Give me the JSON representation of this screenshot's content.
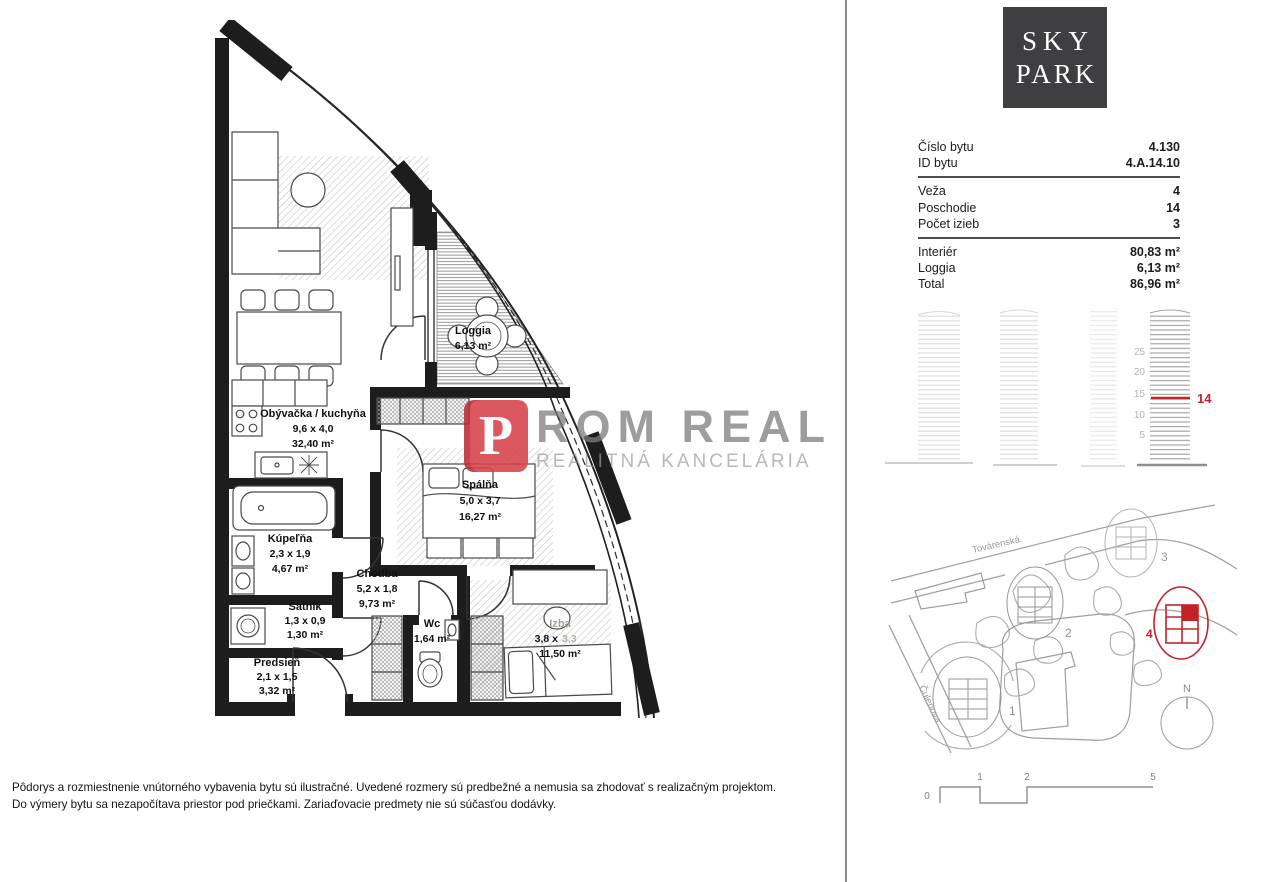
{
  "logo": {
    "line1": "SKY",
    "line2": "PARK"
  },
  "watermark": {
    "prefix": "P",
    "name": "ROM REAL",
    "subtitle": "REALITNÁ KANCELÁRIA"
  },
  "info": {
    "rows": [
      {
        "label": "Číslo bytu",
        "value": "4.130"
      },
      {
        "label": "ID bytu",
        "value": "4.A.14.10"
      },
      {
        "label": "Veža",
        "value": "4"
      },
      {
        "label": "Poschodie",
        "value": "14"
      },
      {
        "label": "Počet izieb",
        "value": "3"
      },
      {
        "label": "Interiér",
        "value": "80,83 m²"
      },
      {
        "label": "Loggia",
        "value": "6,13 m²"
      },
      {
        "label": "Total",
        "value": "86,96 m²"
      }
    ]
  },
  "floorplan": {
    "rooms": [
      {
        "name": "Obývačka / kuchyňa",
        "dims": "9,6 x 4,0",
        "area": "32,40 m²"
      },
      {
        "name": "Loggia",
        "area": "6,13 m²"
      },
      {
        "name": "Spálňa",
        "dims": "5,0 x 3,7",
        "area": "16,27 m²"
      },
      {
        "name": "Kúpeľňa",
        "dims": "2,3 x 1,9",
        "area": "4,67 m²"
      },
      {
        "name": "Chodba",
        "dims": "5,2 x 1,8",
        "area": "9,73 m²"
      },
      {
        "name": "Šatník",
        "dims": "1,3 x 0,9",
        "area": "1,30 m²"
      },
      {
        "name": "Wc",
        "area": "1,64 m²"
      },
      {
        "name": "Izba",
        "dims_dark": "3,8 x",
        "dims_faint": "3,3",
        "area": "11,50 m²"
      },
      {
        "name": "Predsieň",
        "dims": "2,1 x 1,5",
        "area": "3,32 m²"
      }
    ]
  },
  "elevation": {
    "floor_labels": [
      "25",
      "20",
      "15",
      "10",
      "5"
    ],
    "highlighted_floor": "14"
  },
  "site_map": {
    "street_top": "Továrenská",
    "street_left": "Čulenova",
    "tower_labels": [
      "1",
      "2",
      "3"
    ],
    "highlighted_tower": "4",
    "compass": "N"
  },
  "scale_bar": {
    "labels": [
      "0",
      "1",
      "2",
      "5"
    ]
  },
  "disclaimer": {
    "line1": "Pôdorys a rozmiestnenie vnútorného vybavenia bytu sú ilustračné. Uvedené rozmery sú predbežné a nemusia sa zhodovať s realizačným projektom.",
    "line2": "Do výmery bytu sa nezapočítava priestor pod priečkami. Zariaďovacie predmety nie sú súčasťou dodávky."
  },
  "colors": {
    "accent_red": "#c2232a",
    "logo_background": "#3f3f41",
    "watermark_red": "#d8414b",
    "watermark_gray": "#8f8f8f"
  }
}
